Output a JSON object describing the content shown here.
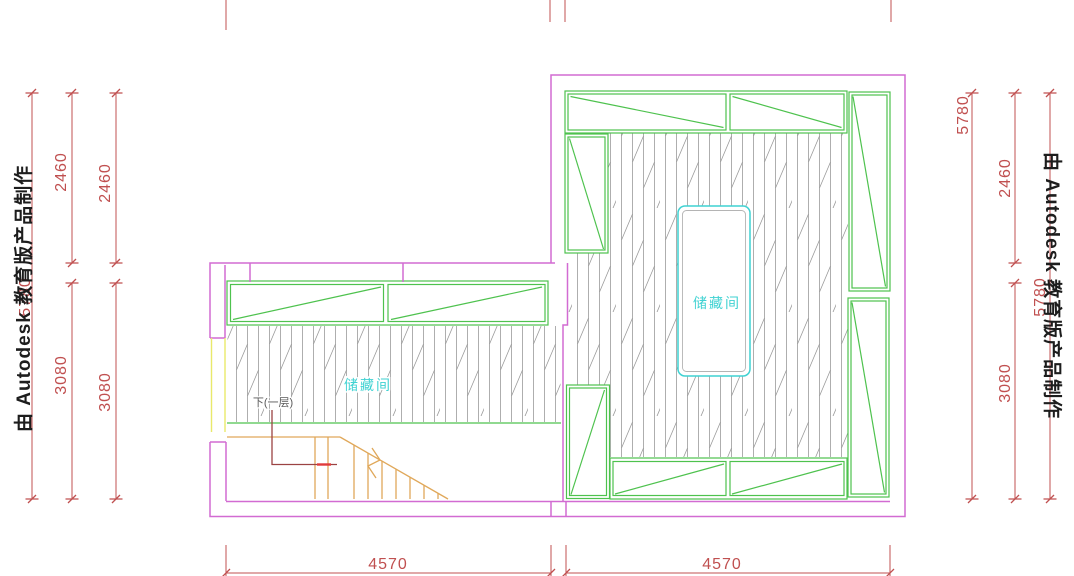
{
  "watermark": {
    "left": "由 Autodesk 教育版产品制作",
    "right": "由 Autodesk 教育版产品制作"
  },
  "labels": {
    "right_room": "储藏间",
    "left_room": "储藏间",
    "stair_note": "下(一层)"
  },
  "dims": {
    "total_height": "5780",
    "upper": "2460",
    "lower": "3080",
    "bottom_left": "4570",
    "bottom_right": "4570"
  },
  "colors": {
    "wall": "#d26bd2",
    "cab": "#4ec24e",
    "hatch": "#9a9a9a",
    "cyan": "#3fd2d2",
    "yellow": "#e9e96a",
    "stair": "#e0a85a",
    "route": "#9b4343",
    "routedash": "#e03a3a",
    "dim": "#c05050",
    "ink": "#1d1d1d",
    "note": "#5a5a5a",
    "objinner": "#b4b4b4"
  }
}
